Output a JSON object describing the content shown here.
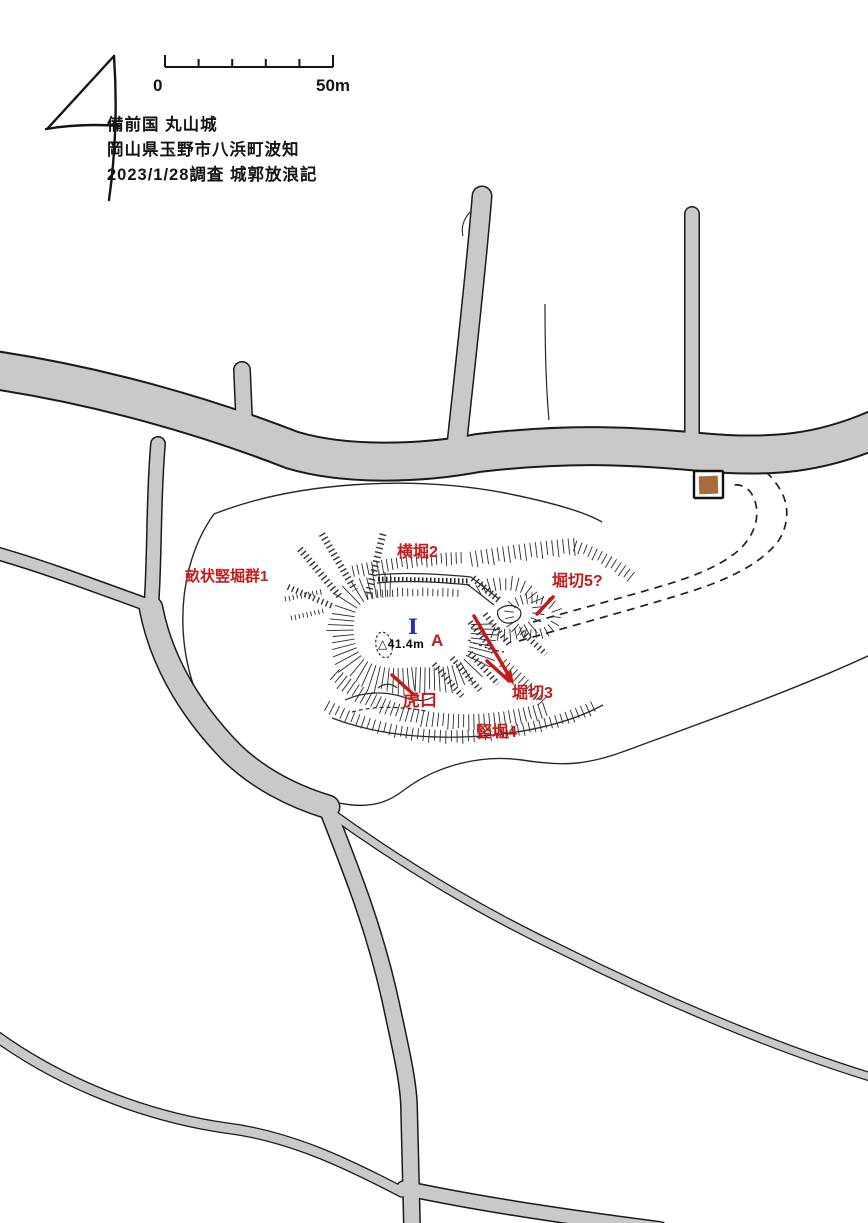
{
  "page": {
    "width_px": 868,
    "height_px": 1223,
    "background": "#ffffff"
  },
  "header": {
    "title_line1": "備前国 丸山城",
    "title_line2": "岡山県玉野市八浜町波知",
    "title_line3": "2023/1/28調査 城郭放浪記"
  },
  "scale_bar": {
    "zero_label": "0",
    "end_label": "50m",
    "segments": 5
  },
  "compass": {
    "type": "hand-drawn north arrow"
  },
  "feature_labels": {
    "unejo_tatebori_gun1": "畝状竪堀群1",
    "yokobori2": "横堀2",
    "horikiri5": "堀切5?",
    "horikiri3": "堀切3",
    "tatebori4": "竪堀4",
    "koguchi": "虎口"
  },
  "point_markers": {
    "main_enclosure": "I",
    "point_a": "A",
    "elevation": "△41.4m"
  },
  "icons": {
    "north_arrow_icon": "hand-drawn-4-shaped-arrow",
    "building_marker": "brown-filled-square-outline"
  },
  "colors": {
    "road_fill": "#c9c9c9",
    "ink": "#1a1a1a",
    "label_red": "#c41a1a",
    "marker_blue": "#2230c0",
    "building_brown": "#a96a3d"
  }
}
